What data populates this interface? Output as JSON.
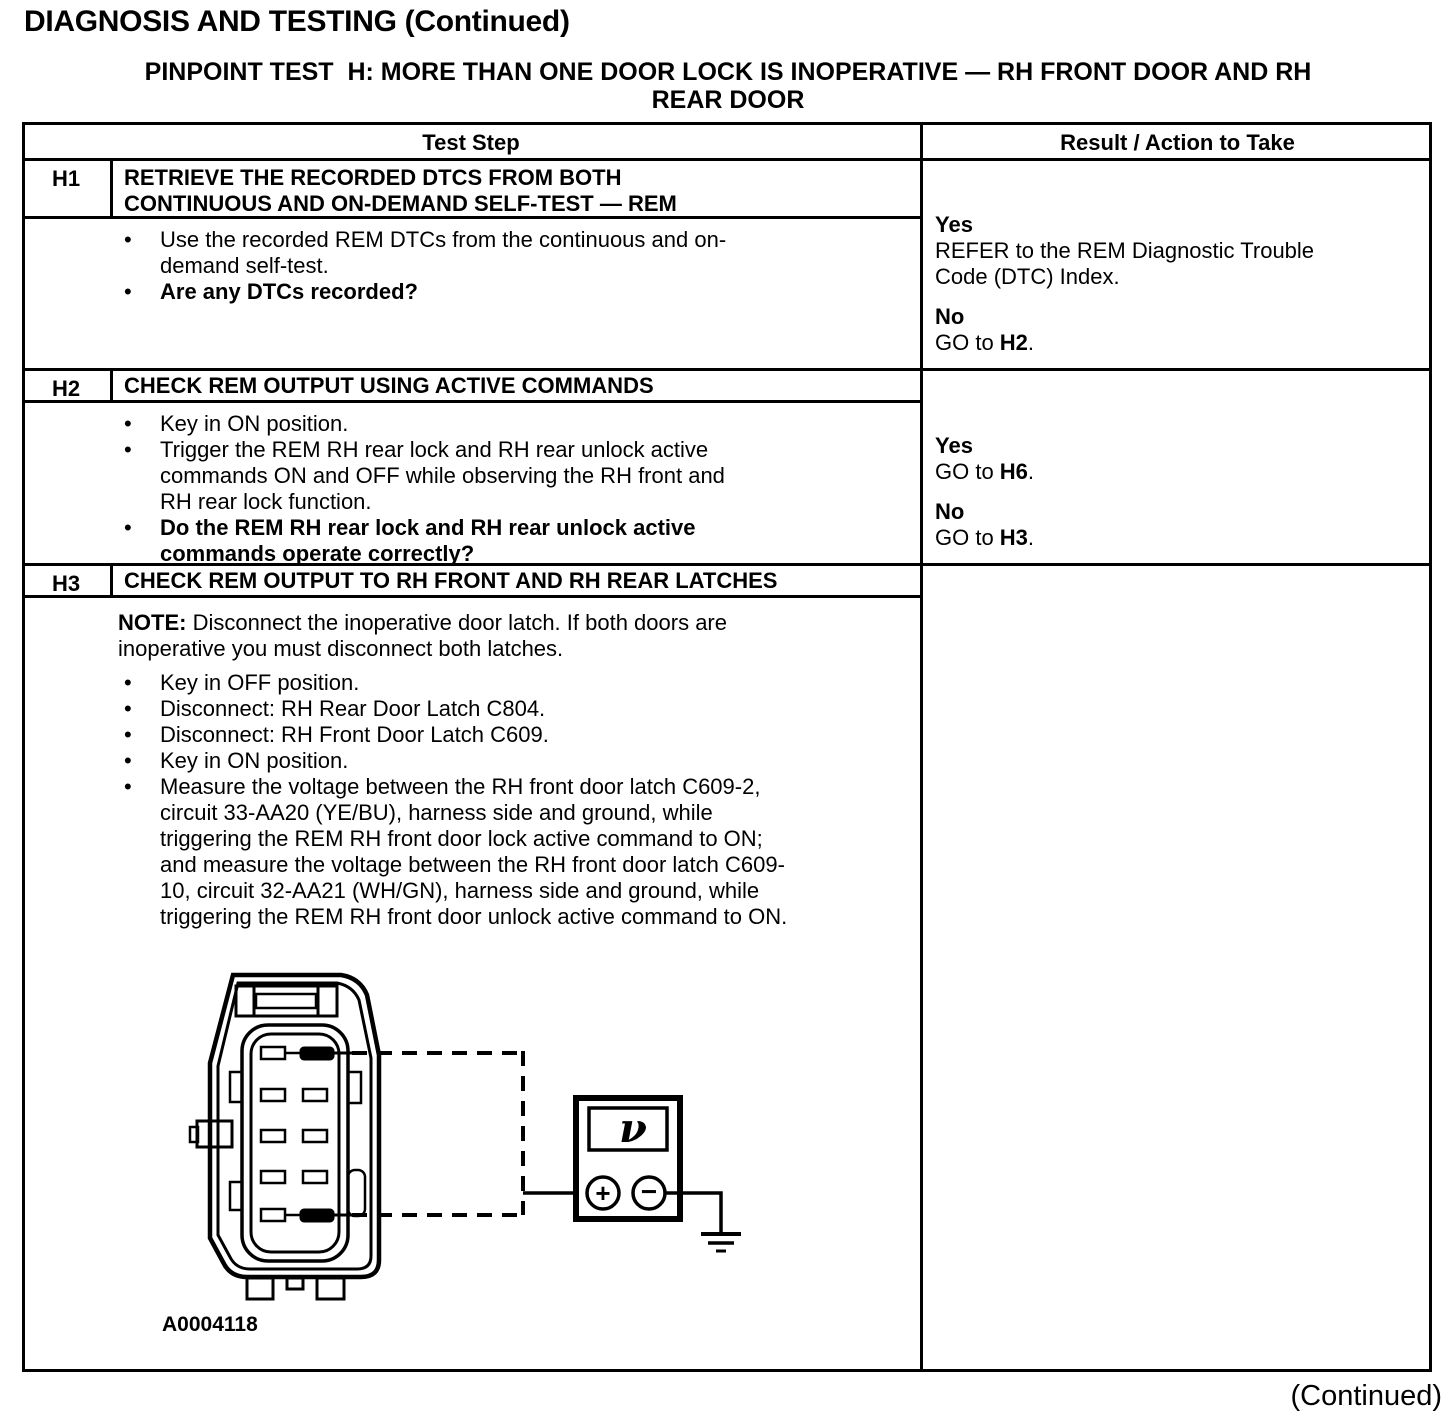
{
  "page": {
    "title": "DIAGNOSIS AND TESTING (Continued)",
    "subtitle_lines": [
      "PINPOINT TEST  H: MORE THAN ONE DOOR LOCK IS INOPERATIVE — RH FRONT DOOR AND RH",
      "REAR DOOR"
    ],
    "continued": "(Continued)"
  },
  "chars": {
    "bullet": "•"
  },
  "table": {
    "header": {
      "test_step": "Test Step",
      "result": "Result / Action to Take"
    },
    "rows": [
      {
        "id": "H1",
        "title": "RETRIEVE THE RECORDED DTCS FROM BOTH CONTINUOUS AND ON-DEMAND SELF-TEST — REM",
        "bullets": [
          {
            "text": "Use the recorded REM DTCs from the continuous and on-demand self-test.",
            "bold": false
          },
          {
            "text": "Are any DTCs recorded?",
            "bold": true
          }
        ],
        "results": [
          {
            "label": "Yes",
            "pre": "REFER to the REM Diagnostic Trouble Code (DTC) Index.",
            "ref": "",
            "post": ""
          },
          {
            "label": "No",
            "pre": "GO to ",
            "ref": "H2",
            "post": "."
          }
        ]
      },
      {
        "id": "H2",
        "title": "CHECK REM OUTPUT USING ACTIVE COMMANDS",
        "bullets": [
          {
            "text": "Key in ON position.",
            "bold": false
          },
          {
            "text": "Trigger the REM RH rear lock and RH rear unlock active commands ON and OFF while observing the RH front and RH rear lock function.",
            "bold": false
          },
          {
            "text": "Do the REM RH rear lock and RH rear unlock active commands operate correctly?",
            "bold": true
          }
        ],
        "results": [
          {
            "label": "Yes",
            "pre": "GO to ",
            "ref": "H6",
            "post": "."
          },
          {
            "label": "No",
            "pre": "GO to ",
            "ref": "H3",
            "post": "."
          }
        ]
      },
      {
        "id": "H3",
        "title": "CHECK REM OUTPUT TO RH FRONT AND RH REAR LATCHES",
        "note_label": "NOTE:",
        "note_text": " Disconnect the inoperative door latch. If both doors are inoperative you must disconnect both latches.",
        "bullets": [
          {
            "text": "Key in OFF position.",
            "bold": false
          },
          {
            "text": "Disconnect: RH Rear Door Latch C804.",
            "bold": false
          },
          {
            "text": "Disconnect: RH Front Door Latch C609.",
            "bold": false
          },
          {
            "text": "Key in ON position.",
            "bold": false
          },
          {
            "text": "Measure the voltage between the RH front door latch C609-2, circuit 33-AA20 (YE/BU), harness side and ground, while triggering the REM RH front door lock active command to ON; and measure the voltage between the RH front door latch C609-10, circuit 32-AA21 (WH/GN), harness side and ground, while triggering the REM RH front door unlock active command to ON.",
            "bold": false
          }
        ],
        "results": []
      }
    ]
  },
  "diagram": {
    "figure_label": "A0004118",
    "voltmeter_symbol": "ν",
    "plus": "+",
    "minus": "−"
  }
}
